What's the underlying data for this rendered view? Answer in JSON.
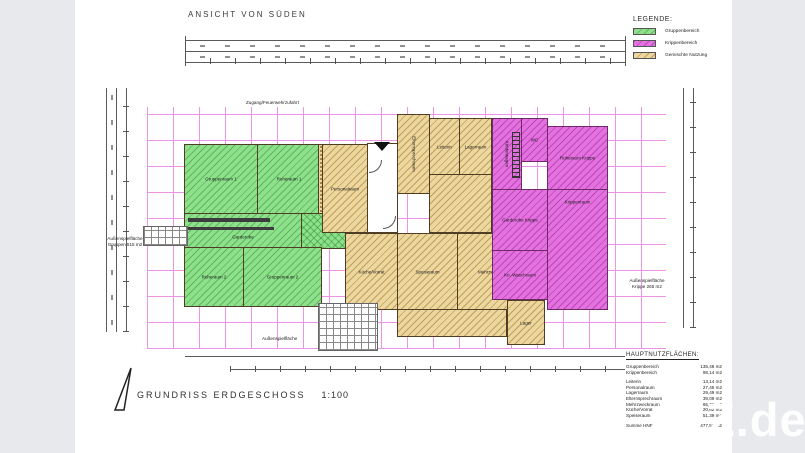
{
  "titles": {
    "top_view": "ANSICHT VON SÜDEN",
    "plan_title": "GRUNDRISS ERDGESCHOSS",
    "plan_scale": "1:100"
  },
  "legend": {
    "title": "LEGENDE:",
    "items": [
      {
        "label": "Gruppenbereich",
        "color": "#8fe08d"
      },
      {
        "label": "Krippenbereich",
        "color": "#e372df"
      },
      {
        "label": "Gemischte Nutzung",
        "color": "#ecd79e"
      }
    ]
  },
  "annotations": {
    "access": "Zugang/Feuerwehrzufahrt",
    "play_left_1": "Außenspielfläche",
    "play_left_2": "Gruppen 515 m2",
    "play_right_1": "Außenspielfläche",
    "play_right_2": "Krippe 265 m2",
    "play_bottom": "Außenspielfläche"
  },
  "rooms": {
    "gruppenraum1": "Gruppenraum 1",
    "ruheraum1": "Ruheraum 1",
    "garderobe": "Garderobe",
    "sanitaer": "Sanitärbereich",
    "ruheraum2": "Ruheraum 2",
    "gruppenraum2": "Gruppenraum 2",
    "personalraum": "Personalraum",
    "elternsprech": "Elternsprechraum",
    "leiterin": "Leiterin",
    "lagerraum": "Lagerraum",
    "kueche": "Küche/Vorrat",
    "speiseraum": "Speiseraum",
    "mehrzweck": "Mehrzweckraum",
    "kinderwagen": "Kinderwagen",
    "wc_krippe": "WC",
    "ruheraum_krippe": "Ruheraum Krippe",
    "garderobe_krippe": "Garderobe Krippe",
    "krippenraum": "Krippenraum",
    "waschraum": "Kri.-Waschraum",
    "lager2": "Lager"
  },
  "area_table": {
    "title": "HAUPTNUTZFLÄCHEN:",
    "rows": [
      {
        "label": "Gruppenbereich",
        "value": "135,48 m2"
      },
      {
        "label": "Krippenbereich",
        "value": "98,14 m2"
      },
      {
        "label": "Leiterin",
        "value": "13,14 m2"
      },
      {
        "label": "Personalraum",
        "value": "27,45 m2"
      },
      {
        "label": "Lagerraum",
        "value": "29,49 m2"
      },
      {
        "label": "Elternsprechraum",
        "value": "39,09 m2"
      },
      {
        "label": "Mehrzweckraum",
        "value": "65,70 m2"
      },
      {
        "label": "Küche/Vorrat",
        "value": "20,62 m2"
      },
      {
        "label": "Speiseraum",
        "value": "51,39 m2"
      },
      {
        "label": "Summe HNF",
        "value": "477,51 m2"
      }
    ]
  },
  "watermark": "Z.de"
}
